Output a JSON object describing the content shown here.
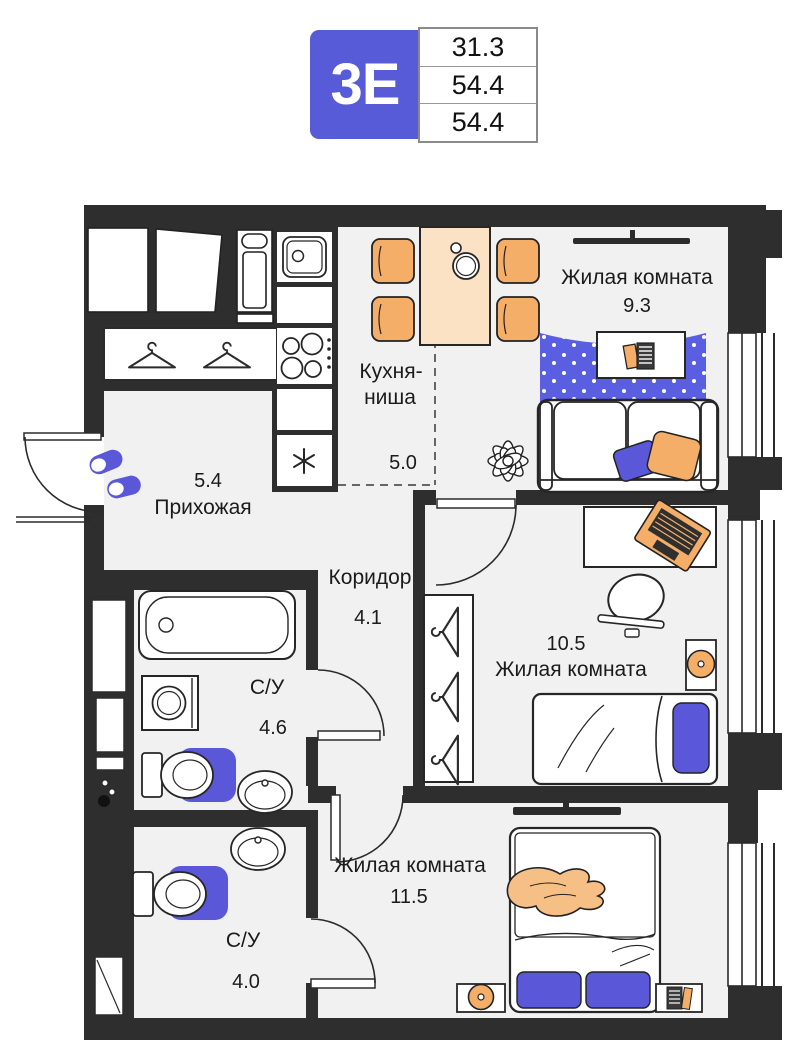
{
  "badge": {
    "type_label": "3Е",
    "areas": {
      "living": "31.3",
      "total": "54.4",
      "full": "54.4"
    },
    "accent_color": "#575bd8"
  },
  "rooms": {
    "living1": {
      "name": "Жилая комната",
      "area": "9.3"
    },
    "kitchen": {
      "name_line1": "Кухня-",
      "name_line2": "ниша",
      "area": "5.0"
    },
    "hallway": {
      "name": "Прихожая",
      "area": "5.4"
    },
    "corridor": {
      "name": "Коридор",
      "area": "4.1"
    },
    "bathroom1": {
      "name": "С/У",
      "area": "4.6"
    },
    "living2": {
      "name": "Жилая комната",
      "area": "10.5"
    },
    "living3": {
      "name": "Жилая комната",
      "area": "11.5"
    },
    "bathroom2": {
      "name": "С/У",
      "area": "4.0"
    }
  },
  "colors": {
    "wall": "#2e2e2e",
    "floor": "#f1f1f1",
    "accent_blue": "#5a58d8",
    "rug_blue": "#5a5fe2",
    "furniture_orange": "#f4ae68",
    "table_peach": "#fbe2c4"
  }
}
